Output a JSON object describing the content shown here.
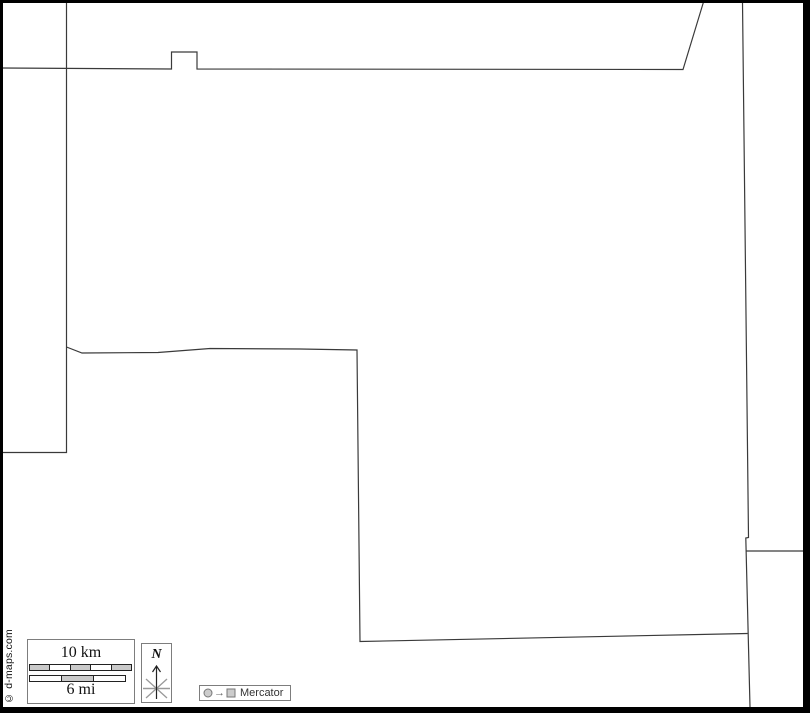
{
  "credit": "© d-maps.com",
  "scale_bar": {
    "km_label": "10 km",
    "mi_label": "6 mi",
    "km_fills": [
      "#c9c9c9",
      "#ffffff",
      "#c9c9c9",
      "#ffffff",
      "#c9c9c9"
    ],
    "mi_fills": [
      "#ffffff",
      "#c9c9c9",
      "#ffffff"
    ]
  },
  "compass": {
    "label": "N"
  },
  "projection": {
    "label": "Mercator",
    "arrow": "→"
  },
  "colors": {
    "outline_stroke": "#3a3a3a",
    "frame": "#000000",
    "legend_fill": "#cccccc",
    "legend_stroke": "#777777",
    "star_gray": "#999999"
  },
  "map_outline": {
    "boundaries": [
      {
        "id": "west-boundary",
        "points": [
          [
            66.5,
            3
          ],
          [
            66.5,
            452.5
          ],
          [
            2,
            452.5
          ]
        ]
      },
      {
        "id": "north-boundary",
        "points": [
          [
            2,
            68
          ],
          [
            171.5,
            69
          ],
          [
            171.5,
            52
          ],
          [
            197,
            52
          ],
          [
            197,
            69
          ],
          [
            683,
            69.5
          ],
          [
            703.5,
            2
          ]
        ]
      },
      {
        "id": "east-boundary",
        "points": [
          [
            742.5,
            2
          ],
          [
            748.5,
            537.5
          ],
          [
            745.8,
            538
          ],
          [
            750,
            707
          ]
        ]
      },
      {
        "id": "east-spur",
        "points": [
          [
            746.5,
            551
          ],
          [
            808,
            551
          ]
        ]
      },
      {
        "id": "central-boundary",
        "points": [
          [
            66.5,
            347
          ],
          [
            82,
            353
          ],
          [
            158,
            352.5
          ],
          [
            210,
            348.5
          ],
          [
            300,
            349
          ],
          [
            357,
            350
          ],
          [
            360,
            641.5
          ],
          [
            747.5,
            633.5
          ]
        ]
      }
    ]
  }
}
